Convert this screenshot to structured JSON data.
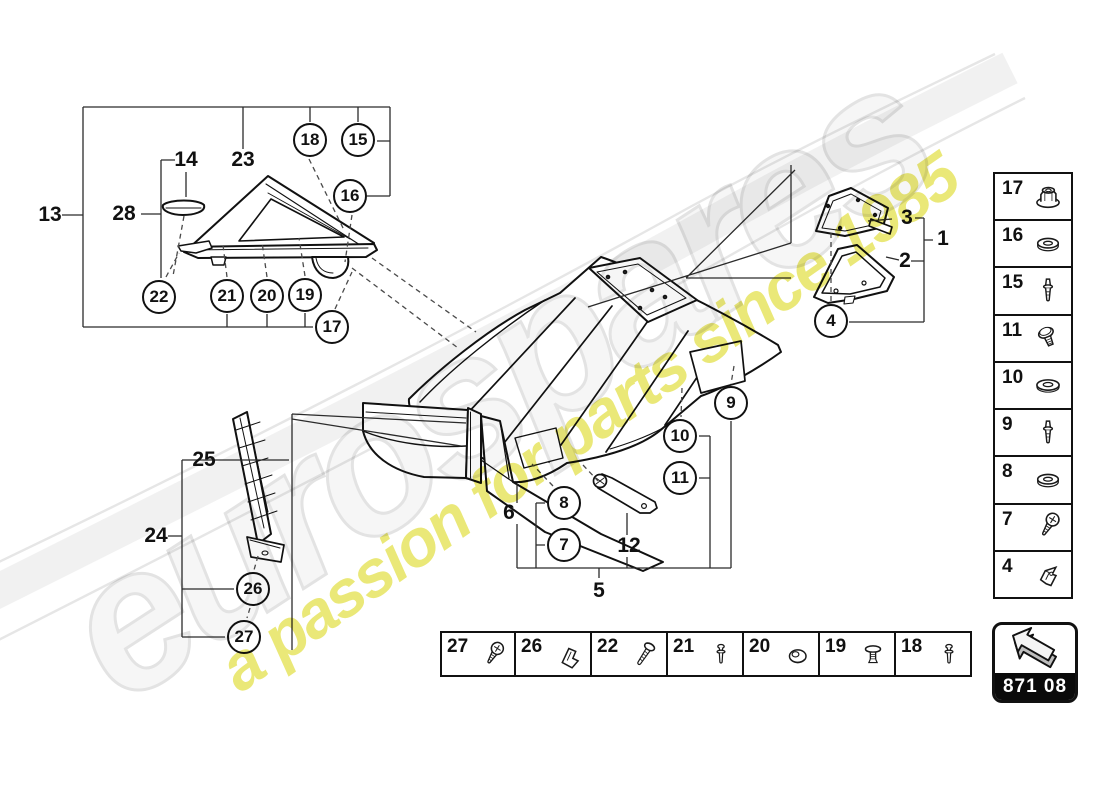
{
  "watermark": {
    "brand": "eurospares",
    "tagline": "a passion for parts since 1985"
  },
  "colors": {
    "line": "#111111",
    "leader": "#2b2b2b",
    "watermark_gray": "#e3e3e3",
    "watermark_yellow": "#eae878",
    "code_bar_bg": "#0a0a0a"
  },
  "code_box": {
    "code": "871 08",
    "icon": "arrow-up-left"
  },
  "fastener_column": {
    "items": [
      {
        "ref": "17",
        "icon": "flange-nut"
      },
      {
        "ref": "16",
        "icon": "washer"
      },
      {
        "ref": "15",
        "icon": "rivet-pin"
      },
      {
        "ref": "11",
        "icon": "bolt"
      },
      {
        "ref": "10",
        "icon": "washer-flat"
      },
      {
        "ref": "9",
        "icon": "rivet-pin"
      },
      {
        "ref": "8",
        "icon": "washer"
      },
      {
        "ref": "7",
        "icon": "pan-screw"
      },
      {
        "ref": "4",
        "icon": "clip-nut"
      }
    ]
  },
  "fastener_row": {
    "items": [
      {
        "ref": "27",
        "icon": "pan-screw"
      },
      {
        "ref": "26",
        "icon": "clip"
      },
      {
        "ref": "22",
        "icon": "thread-screw"
      },
      {
        "ref": "21",
        "icon": "small-pin"
      },
      {
        "ref": "20",
        "icon": "grommet"
      },
      {
        "ref": "19",
        "icon": "push-rivet"
      },
      {
        "ref": "18",
        "icon": "small-pin"
      }
    ]
  },
  "callouts": {
    "circled": [
      {
        "ref": "18",
        "x": 310,
        "y": 140
      },
      {
        "ref": "15",
        "x": 358,
        "y": 140
      },
      {
        "ref": "16",
        "x": 350,
        "y": 196
      },
      {
        "ref": "22",
        "x": 159,
        "y": 297
      },
      {
        "ref": "21",
        "x": 227,
        "y": 296
      },
      {
        "ref": "20",
        "x": 267,
        "y": 296
      },
      {
        "ref": "19",
        "x": 305,
        "y": 295
      },
      {
        "ref": "17",
        "x": 332,
        "y": 327
      },
      {
        "ref": "4",
        "x": 831,
        "y": 321
      },
      {
        "ref": "9",
        "x": 731,
        "y": 403
      },
      {
        "ref": "10",
        "x": 680,
        "y": 436
      },
      {
        "ref": "11",
        "x": 680,
        "y": 478
      },
      {
        "ref": "8",
        "x": 564,
        "y": 503
      },
      {
        "ref": "7",
        "x": 564,
        "y": 545
      },
      {
        "ref": "26",
        "x": 253,
        "y": 589
      },
      {
        "ref": "27",
        "x": 244,
        "y": 637
      }
    ],
    "plain": [
      {
        "ref": "13",
        "x": 50,
        "y": 215
      },
      {
        "ref": "14",
        "x": 186,
        "y": 160
      },
      {
        "ref": "23",
        "x": 243,
        "y": 160
      },
      {
        "ref": "28",
        "x": 124,
        "y": 214
      },
      {
        "ref": "3",
        "x": 907,
        "y": 218
      },
      {
        "ref": "1",
        "x": 943,
        "y": 239
      },
      {
        "ref": "2",
        "x": 905,
        "y": 261
      },
      {
        "ref": "25",
        "x": 204,
        "y": 460
      },
      {
        "ref": "24",
        "x": 156,
        "y": 536
      },
      {
        "ref": "6",
        "x": 509,
        "y": 513
      },
      {
        "ref": "12",
        "x": 629,
        "y": 546
      },
      {
        "ref": "5",
        "x": 599,
        "y": 591
      }
    ]
  }
}
